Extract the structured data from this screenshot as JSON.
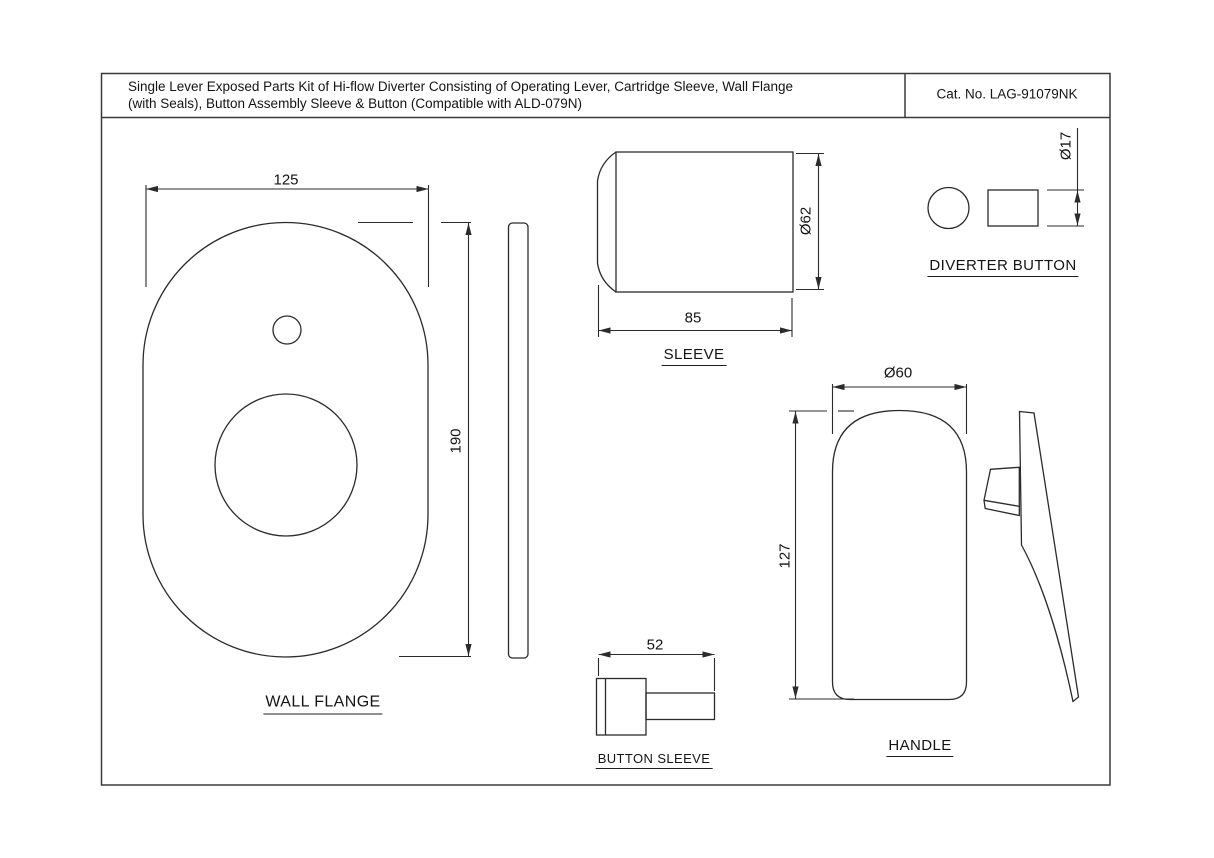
{
  "page": {
    "background_color": "#ffffff",
    "line_color": "#2b2b2b",
    "text_color": "#141414"
  },
  "title_block": {
    "description_line1": "Single Lever Exposed Parts Kit of Hi-flow Diverter Consisting of Operating Lever, Cartridge Sleeve, Wall Flange",
    "description_line2": "(with Seals), Button Assembly Sleeve & Button (Compatible with ALD-079N)",
    "catalog_number": "Cat. No. LAG-91079NK"
  },
  "parts": {
    "wall_flange": {
      "label": "WALL FLANGE",
      "width": "125",
      "height": "190"
    },
    "sleeve": {
      "label": "SLEEVE",
      "diameter": "Ø62",
      "length": "85"
    },
    "diverter_button": {
      "label": "DIVERTER BUTTON",
      "diameter": "Ø17"
    },
    "handle": {
      "label": "HANDLE",
      "diameter": "Ø60",
      "height": "127"
    },
    "button_sleeve": {
      "label": "BUTTON SLEEVE",
      "length": "52"
    }
  }
}
